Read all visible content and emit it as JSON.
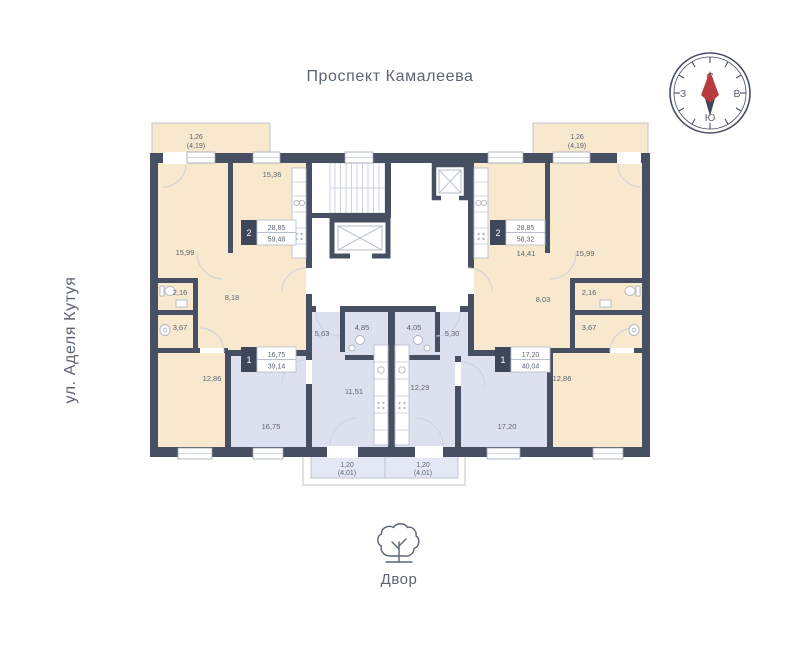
{
  "streets": {
    "top": "Проспект Камалеева",
    "left": "ул. Аделя Кутуя"
  },
  "courtyard": {
    "label": "Двор"
  },
  "compass": {
    "north": "С",
    "south": "Ю",
    "west": "З",
    "east": "В"
  },
  "colors": {
    "wall": "#474f62",
    "apartment_cream": "#f8e8cd",
    "apartment_blue": "#dde1ef",
    "balcony_blue": "#e4e7f4",
    "text": "#5b6473",
    "badge_bg": "#3d4759",
    "compass_red": "#b73a3f",
    "compass_navy": "#3c4658"
  },
  "apartments": {
    "apt_2room_left": {
      "rooms_count": "2",
      "area_living": "28,85",
      "area_total": "59,48",
      "labels": {
        "balcony_l1": "1,26",
        "balcony_l2": "(4,19)",
        "kitchen": "15,36",
        "bedroom1": "15,99",
        "wc": "2,16",
        "hall": "8,18",
        "bath": "3,67",
        "bedroom2": "12,86"
      }
    },
    "apt_2room_right": {
      "rooms_count": "2",
      "area_living": "28,85",
      "area_total": "58,32",
      "labels": {
        "balcony_l1": "1,26",
        "balcony_l2": "(4,19)",
        "kitchen": "14,41",
        "bedroom1": "15,99",
        "wc": "2,16",
        "hall": "8,03",
        "bath": "3,67",
        "bedroom2": "12,86"
      }
    },
    "apt_1room_left": {
      "rooms_count": "1",
      "area_living": "16,75",
      "area_total": "39,14",
      "labels": {
        "hall": "5,63",
        "bath": "4,85",
        "kitchen": "11,51",
        "living": "16,75",
        "balcony_l1": "1,20",
        "balcony_l2": "(4,01)"
      }
    },
    "apt_1room_right": {
      "rooms_count": "1",
      "area_living": "17,20",
      "area_total": "40,04",
      "labels": {
        "bath": "4,05",
        "hall": "5,30",
        "kitchen": "12,29",
        "living": "17,20",
        "balcony_l1": "1,20",
        "balcony_l2": "(4,01)"
      }
    }
  }
}
